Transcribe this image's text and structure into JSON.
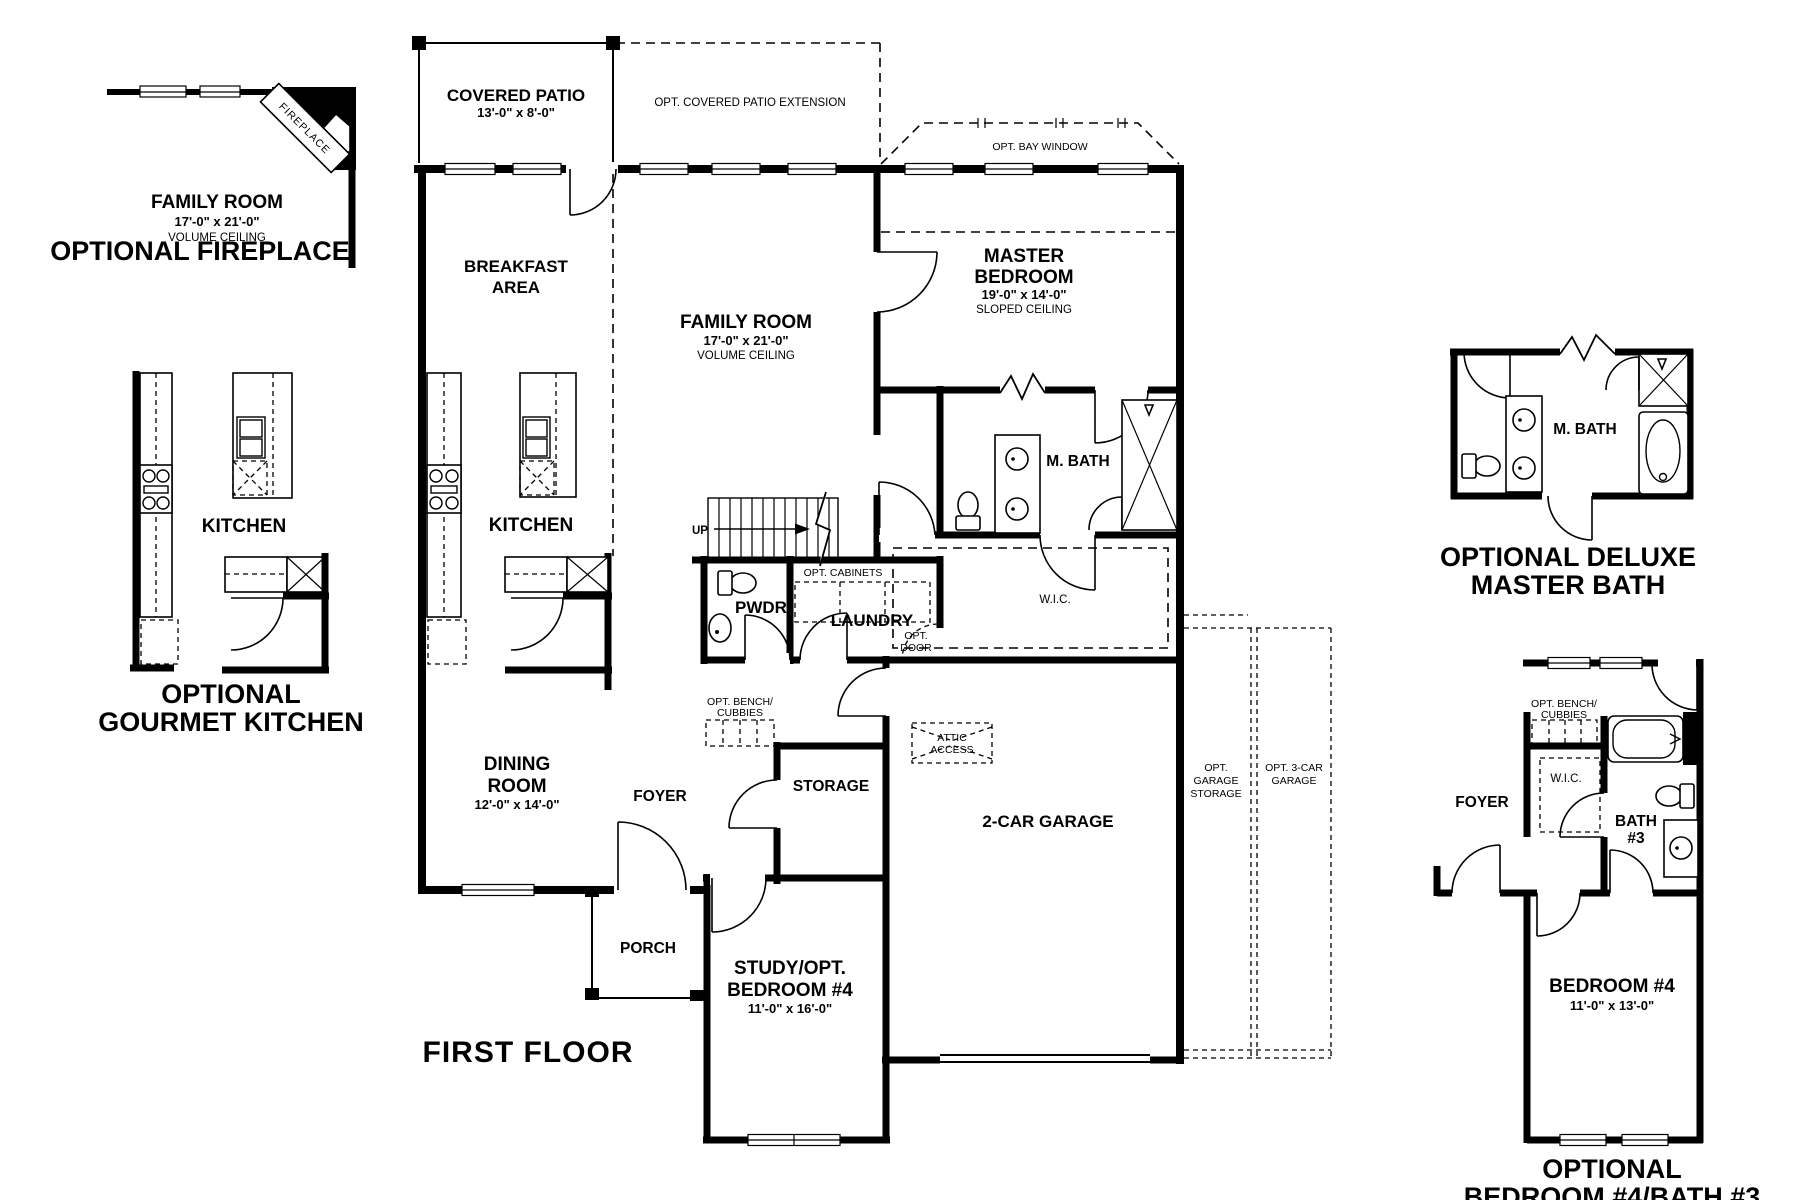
{
  "page": {
    "background": "#ffffff",
    "ink": "#000000"
  },
  "plan": {
    "title": "FIRST FLOOR",
    "covered_patio_name": "COVERED PATIO",
    "covered_patio_dims": "13'-0\" x 8'-0\"",
    "patio_extension": "OPT. COVERED PATIO EXTENSION",
    "bay_window": "OPT. BAY WINDOW",
    "breakfast1": "BREAKFAST",
    "breakfast2": "AREA",
    "family_name": "FAMILY ROOM",
    "family_dims": "17'-0\" x 21'-0\"",
    "family_note": "VOLUME CEILING",
    "master1": "MASTER",
    "master2": "BEDROOM",
    "master_dims": "19'-0\" x 14'-0\"",
    "master_note": "SLOPED CEILING",
    "kitchen": "KITCHEN",
    "dining1": "DINING",
    "dining2": "ROOM",
    "dining_dims": "12'-0\" x 14'-0\"",
    "up": "UP",
    "pwdr": "PWDR",
    "laundry": "LAUNDRY",
    "opt_cabinets": "OPT. CABINETS",
    "opt_door1": "OPT.",
    "opt_door2": "DOOR",
    "mbath": "M. BATH",
    "wic": "W.I.C.",
    "bench1": "OPT. BENCH/",
    "bench2": "CUBBIES",
    "foyer": "FOYER",
    "storage": "STORAGE",
    "attic1": "ATTIC",
    "attic2": "ACCESS",
    "garage": "2-CAR GARAGE",
    "opt_storage1": "OPT.",
    "opt_storage2": "GARAGE",
    "opt_storage3": "STORAGE",
    "opt_3car1": "OPT. 3-CAR",
    "opt_3car2": "GARAGE",
    "porch": "PORCH",
    "study1": "STUDY/OPT.",
    "study2": "BEDROOM #4",
    "study_dims": "11'-0\" x 16'-0\""
  },
  "fireplace_inset": {
    "room": "FAMILY ROOM",
    "dims": "17'-0\" x 21'-0\"",
    "note": "VOLUME CEILING",
    "fixture": "FIREPLACE",
    "caption": "OPTIONAL FIREPLACE"
  },
  "gourmet_inset": {
    "kitchen": "KITCHEN",
    "caption1": "OPTIONAL",
    "caption2": "GOURMET KITCHEN"
  },
  "deluxe_inset": {
    "mbath": "M. BATH",
    "caption1": "OPTIONAL DELUXE",
    "caption2": "MASTER BATH"
  },
  "bed4_inset": {
    "foyer": "FOYER",
    "bench1": "OPT. BENCH/",
    "bench2": "CUBBIES",
    "wic": "W.I.C.",
    "bath1": "BATH",
    "bath2": "#3",
    "bedroom": "BEDROOM #4",
    "bedroom_dims": "11'-0\" x 13'-0\"",
    "caption1": "OPTIONAL",
    "caption2": "BEDROOM #4/BATH #3"
  }
}
